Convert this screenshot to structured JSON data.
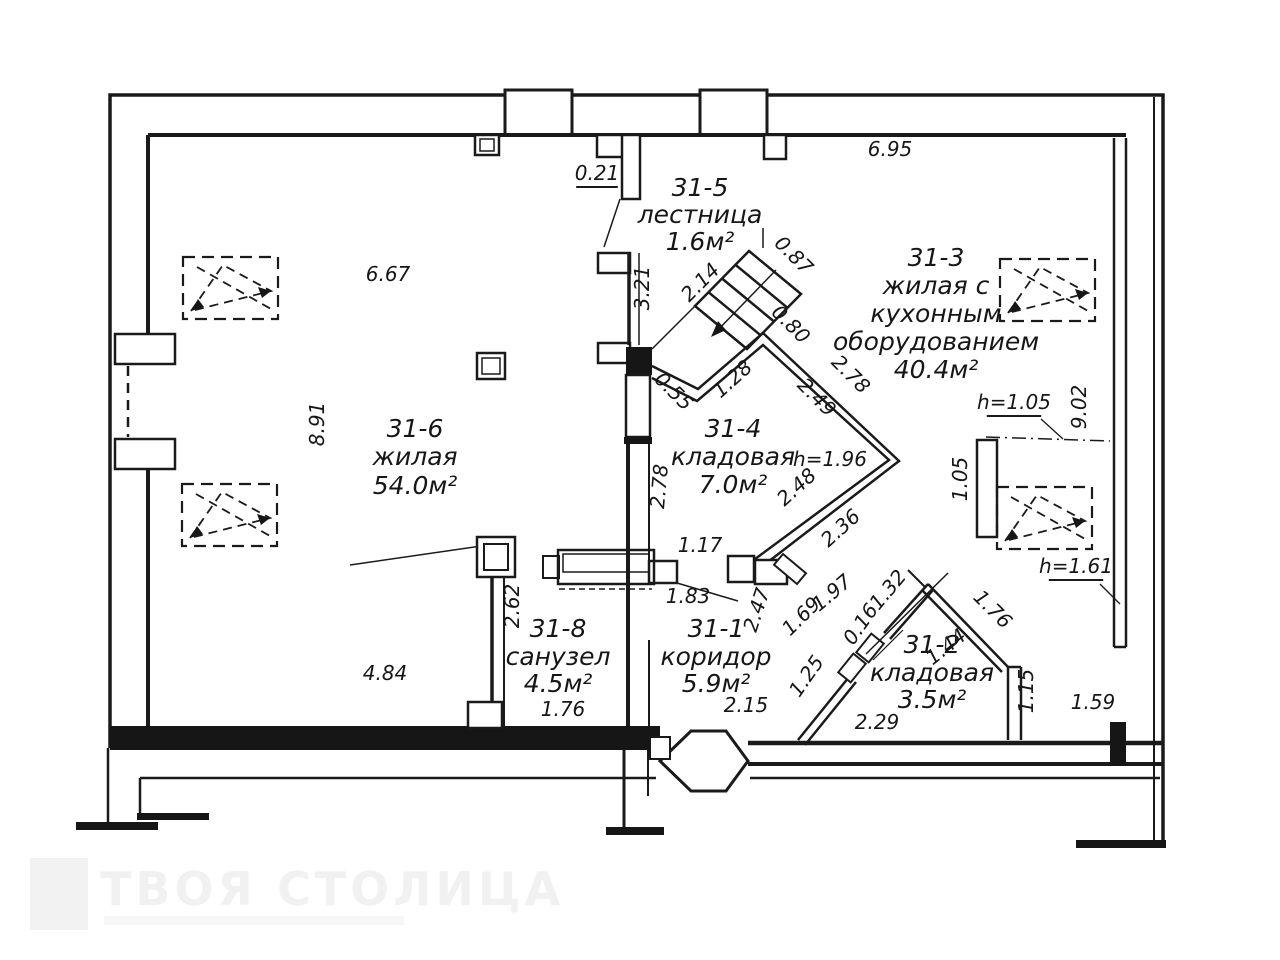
{
  "plan": {
    "rooms": [
      {
        "id": "31-5",
        "name_lines": [
          "лестница"
        ],
        "area": "1.6м²"
      },
      {
        "id": "31-3",
        "name_lines": [
          "жилая с",
          "кухонным",
          "оборудованием"
        ],
        "area": "40.4м²"
      },
      {
        "id": "31-6",
        "name_lines": [
          "жилая"
        ],
        "area": "54.0м²"
      },
      {
        "id": "31-4",
        "name_lines": [
          "кладовая"
        ],
        "area": "7.0м²"
      },
      {
        "id": "31-8",
        "name_lines": [
          "санузел"
        ],
        "area": "4.5м²"
      },
      {
        "id": "31-1",
        "name_lines": [
          "коридор"
        ],
        "area": "5.9м²"
      },
      {
        "id": "31-2",
        "name_lines": [
          "кладовая"
        ],
        "area": "3.5м²"
      }
    ],
    "dimensions": [
      "0.21",
      "6.95",
      "6.67",
      "8.91",
      "3.21",
      "2.14",
      "0.87",
      "0.80",
      "0.55",
      "1.28",
      "2.49",
      "2.78",
      "2.78",
      "2.48",
      "2.36",
      "h=1.96",
      "9.02",
      "h=1.05",
      "1.05",
      "h=1.61",
      "1.17",
      "1.83",
      "2.47",
      "1.69",
      "1.97",
      "0.16",
      "1.32",
      "2.62",
      "1.76",
      "4.84",
      "2.15",
      "1.25",
      "2.29",
      "1.44",
      "1.76",
      "1.15",
      "1.59"
    ]
  },
  "watermark": {
    "brand": "ТВОЯ СТОЛИЦА"
  }
}
